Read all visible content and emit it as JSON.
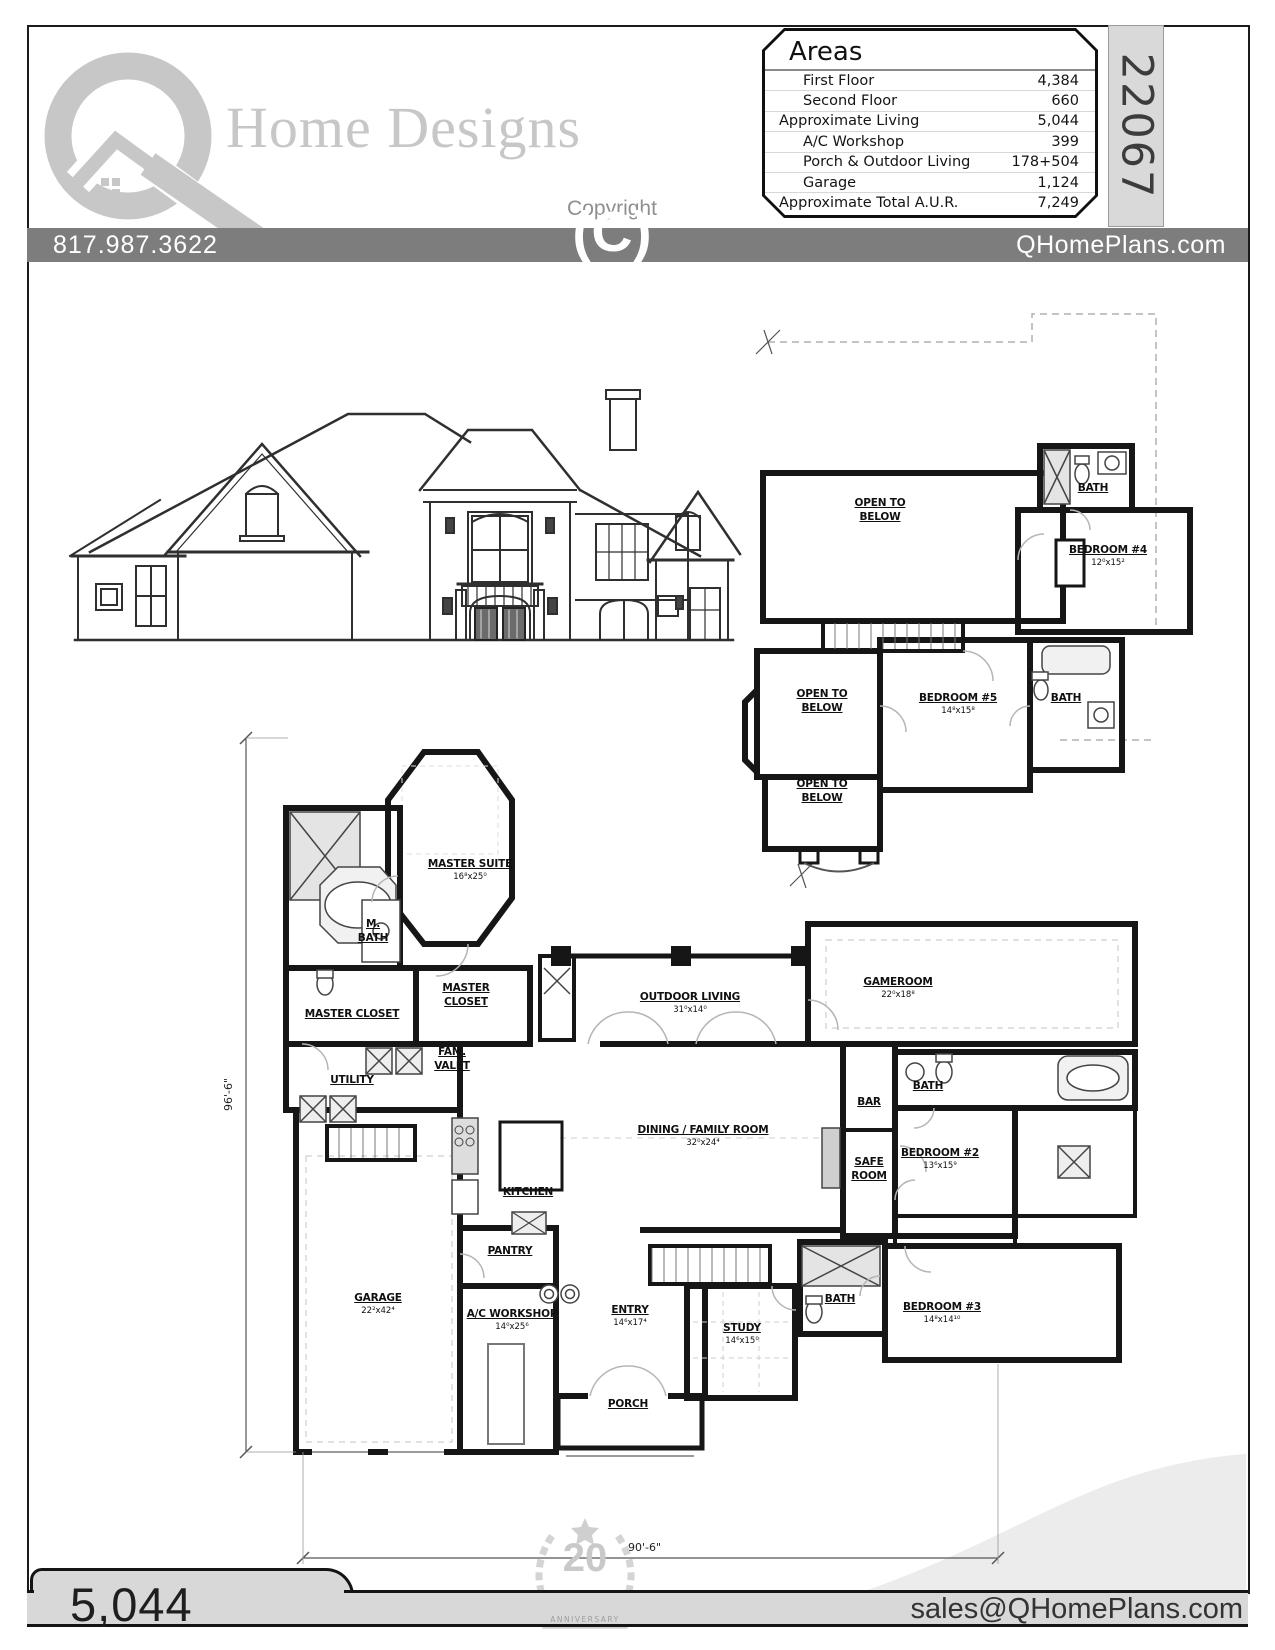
{
  "header": {
    "brand": "Home Designs",
    "copyright_label": "Copyright",
    "copyright_symbol": "(C)",
    "plan_number": "22067"
  },
  "areas_table": {
    "title": "Areas",
    "rows": [
      {
        "label": "First Floor",
        "value": "4,384"
      },
      {
        "label": "Second Floor",
        "value": "660"
      },
      {
        "label": "Approximate Living",
        "value": "5,044"
      },
      {
        "label": "A/C Workshop",
        "value": "399"
      },
      {
        "label": "Porch & Outdoor Living",
        "value": "178+504"
      },
      {
        "label": "Garage",
        "value": "1,124"
      },
      {
        "label": "Approximate Total A.U.R.",
        "value": "7,249"
      }
    ]
  },
  "contact_bar": {
    "phone": "817.987.3622",
    "website": "QHomePlans.com"
  },
  "first_floor": {
    "rooms": [
      {
        "name": "MASTER SUITE",
        "dims": "16⁸x25⁰"
      },
      {
        "name": "M.\nBATH",
        "dims": ""
      },
      {
        "name": "MASTER CLOSET",
        "dims": ""
      },
      {
        "name": "MASTER\nCLOSET",
        "dims": ""
      },
      {
        "name": "FAM.\nVALET",
        "dims": ""
      },
      {
        "name": "UTILITY",
        "dims": ""
      },
      {
        "name": "OUTDOOR LIVING",
        "dims": "31⁰x14⁰"
      },
      {
        "name": "GAMEROOM",
        "dims": "22⁰x18⁸"
      },
      {
        "name": "DINING / FAMILY ROOM",
        "dims": "32⁰x24⁴"
      },
      {
        "name": "KITCHEN",
        "dims": ""
      },
      {
        "name": "BAR",
        "dims": ""
      },
      {
        "name": "BATH",
        "dims": ""
      },
      {
        "name": "SAFE\nROOM",
        "dims": ""
      },
      {
        "name": "BEDROOM #2",
        "dims": "13⁶x15⁹"
      },
      {
        "name": "PANTRY",
        "dims": ""
      },
      {
        "name": "GARAGE",
        "dims": "22²x42⁴"
      },
      {
        "name": "A/C WORKSHOP",
        "dims": "14⁰x25⁶"
      },
      {
        "name": "ENTRY",
        "dims": "14⁶x17⁴"
      },
      {
        "name": "STUDY",
        "dims": "14⁶x15⁰"
      },
      {
        "name": "BATH",
        "dims": ""
      },
      {
        "name": "BEDROOM #3",
        "dims": "14⁸x14¹⁰"
      },
      {
        "name": "PORCH",
        "dims": ""
      }
    ]
  },
  "second_floor": {
    "rooms": [
      {
        "name": "OPEN TO\nBELOW",
        "dims": ""
      },
      {
        "name": "BATH",
        "dims": ""
      },
      {
        "name": "BEDROOM #4",
        "dims": "12⁰x15²"
      },
      {
        "name": "OPEN TO\nBELOW",
        "dims": ""
      },
      {
        "name": "BEDROOM #5",
        "dims": "14⁸x15⁸"
      },
      {
        "name": "BATH",
        "dims": ""
      },
      {
        "name": "OPEN TO\nBELOW",
        "dims": ""
      }
    ]
  },
  "dimensions": {
    "left_height": "96'-6\"",
    "bottom_width": "90'-6\""
  },
  "footer": {
    "sqft": "5,044",
    "email": "sales@QHomePlans.com",
    "badge_number": "20",
    "badge_banner": "ANNIVERSARY"
  },
  "colors": {
    "bar_gray": "#7d7d7d",
    "strip_gray": "#d9d9d9",
    "footer_gray": "#d8d8d8",
    "logo_gray": "#c7c7c7",
    "line_black": "#161616"
  }
}
